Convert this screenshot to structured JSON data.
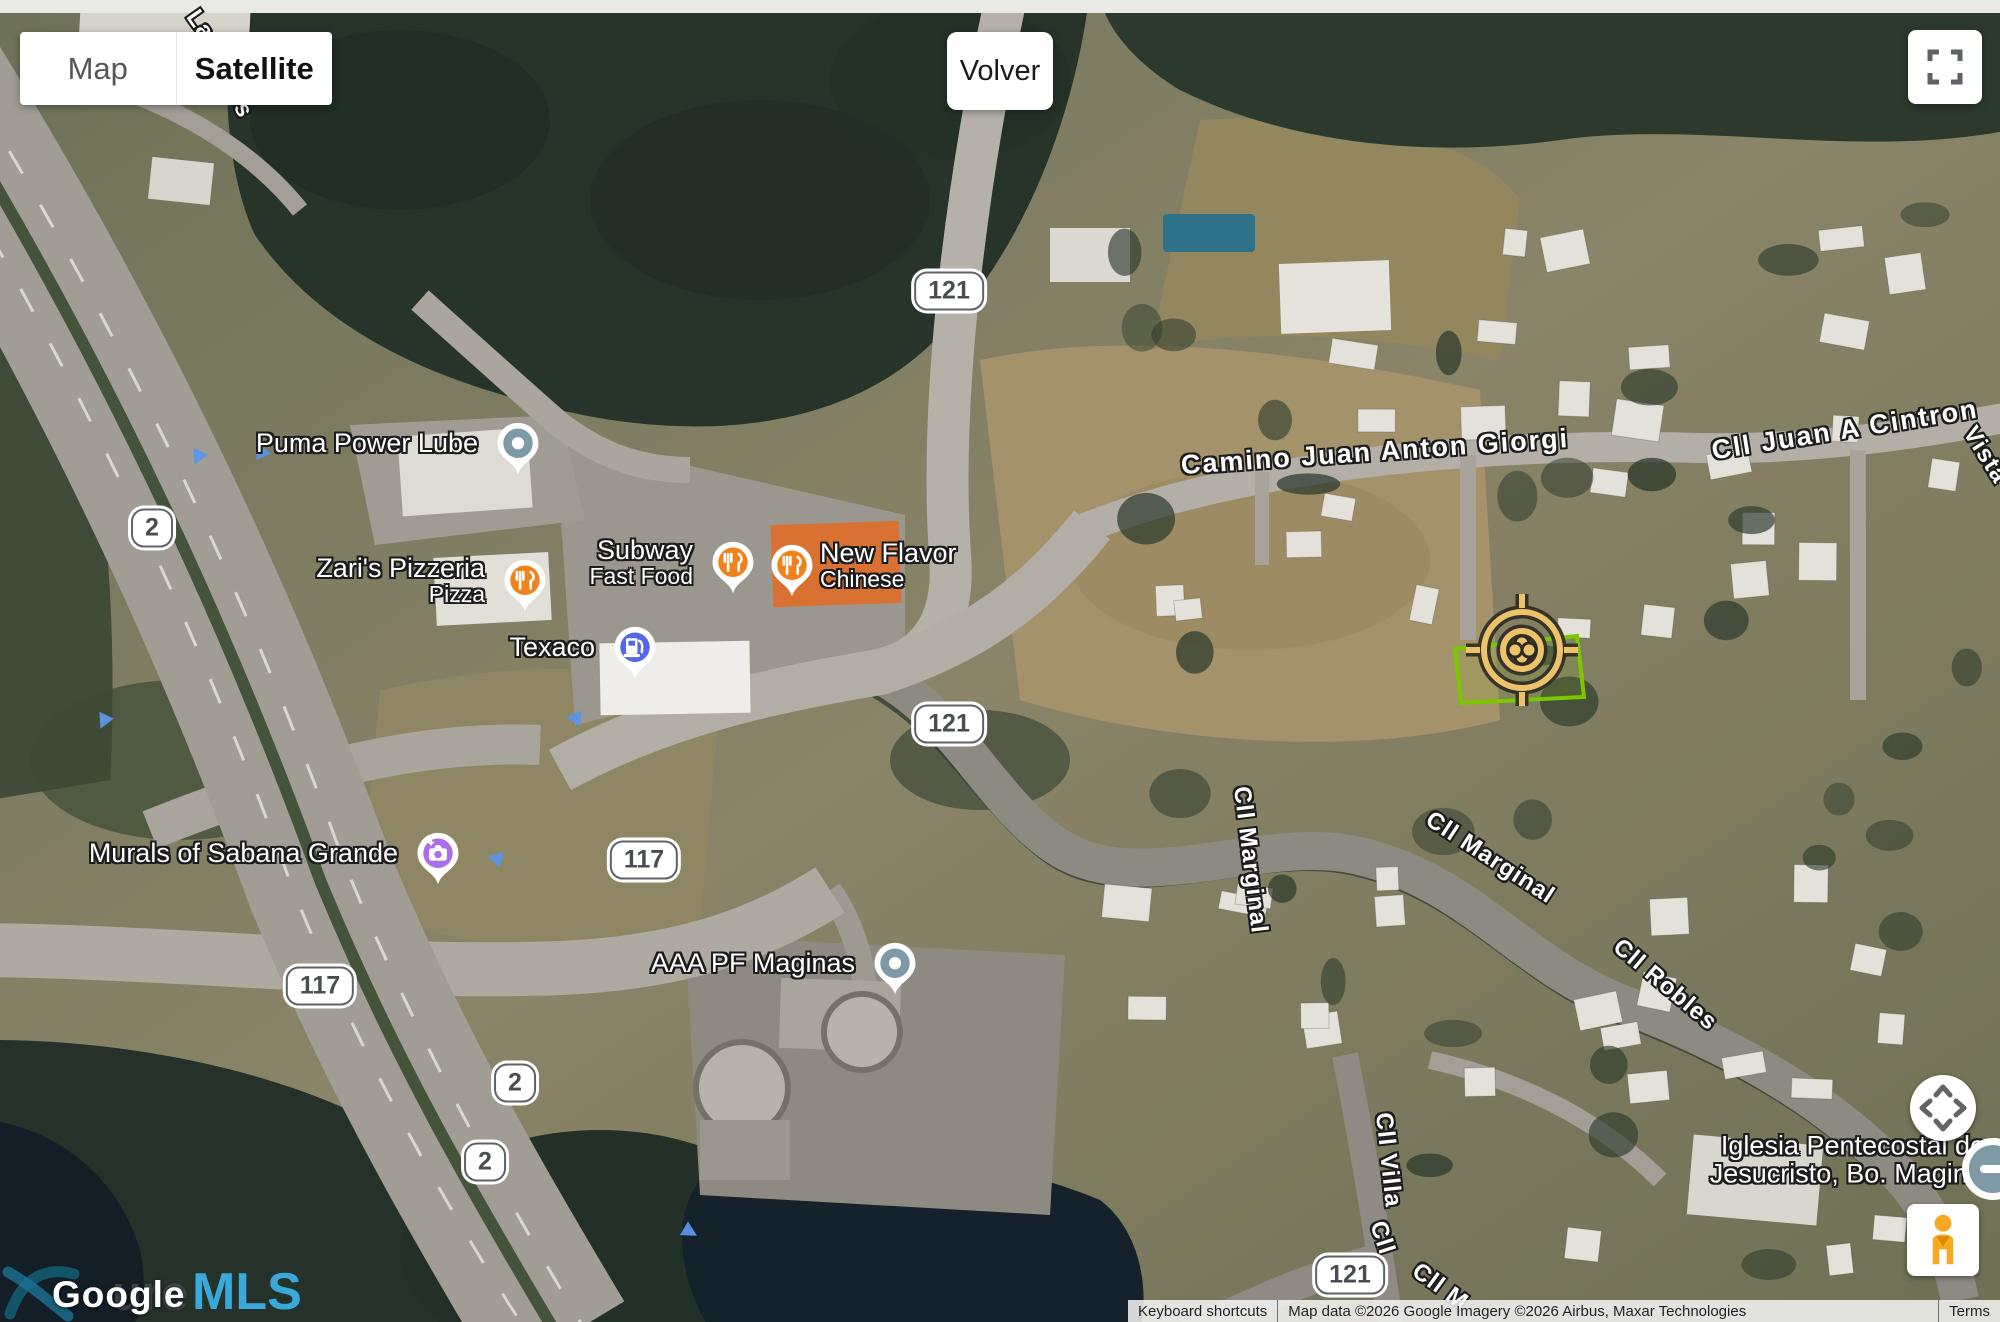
{
  "top_controls": {
    "map": "Map",
    "satellite": "Satellite",
    "volver": "Volver"
  },
  "pois": [
    {
      "name": "Puma Power Lube",
      "category": "generic"
    },
    {
      "name": "Zari's Pizzeria",
      "subtitle": "Pizza",
      "category": "restaurant"
    },
    {
      "name": "Subway",
      "subtitle": "Fast Food",
      "category": "restaurant"
    },
    {
      "name": "New Flavor",
      "subtitle": "Chinese",
      "category": "restaurant"
    },
    {
      "name": "Texaco",
      "category": "gas-station"
    },
    {
      "name": "Murals of Sabana Grande",
      "category": "attraction"
    },
    {
      "name": "AAA PF Maginas",
      "category": "generic"
    },
    {
      "line1": "Iglesia Pentecostal de",
      "line2": "Jesucristo, Bo. Maginas",
      "category": "text-only"
    }
  ],
  "route_shields": [
    "2",
    "121",
    "121",
    "117",
    "117",
    "2",
    "2",
    "121"
  ],
  "street_labels": [
    "La",
    "s",
    "Camino Juan Anton Giorgi",
    "Cll Juan A Cintron",
    "Vista",
    "Cll Marginal",
    "Cll Marginal",
    "Cll Robles",
    "Cll Villa",
    "Cll",
    "Cll M"
  ],
  "watermark": {
    "google": "Google",
    "mls_prefix": "ure",
    "mls": "MLS"
  },
  "attribution": {
    "keyboard_shortcuts": "Keyboard shortcuts",
    "map_data": "Map data ©2026 Google",
    "imagery": "Imagery ©2026 Airbus, Maxar Technologies",
    "terms": "Terms"
  },
  "colors": {
    "restaurant_pin": "#F0821E",
    "gas_pin": "#5468E4",
    "attraction_pin": "#AA6FE8",
    "generic_pin": "#7E9AA6",
    "parcel_outline": "#7CC700",
    "target_amber": "#ECC36A",
    "mls_blue": "#39A9DC"
  }
}
